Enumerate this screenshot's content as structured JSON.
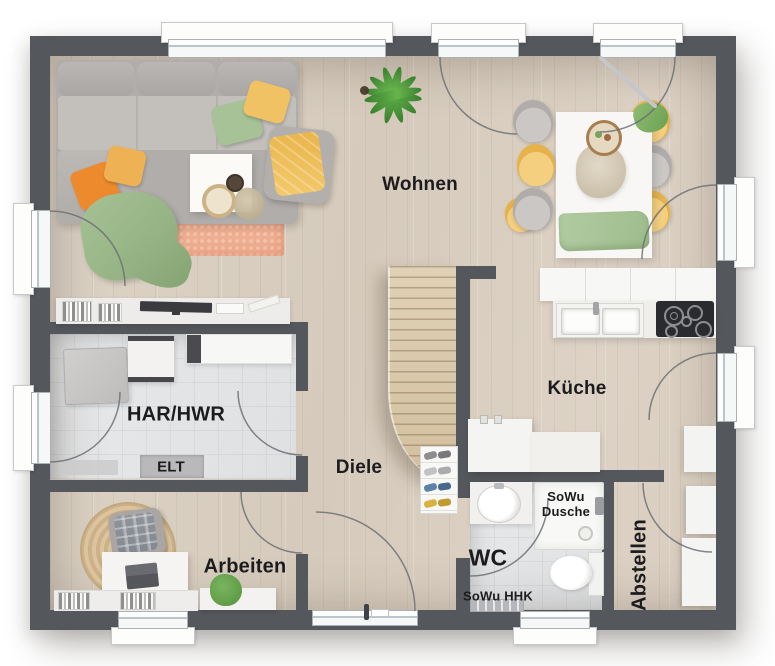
{
  "floorplan": {
    "rooms": {
      "wohnen": "Wohnen",
      "kueche": "Küche",
      "har_hwr": "HAR/HWR",
      "elt": "ELT",
      "diele": "Diele",
      "arbeiten": "Arbeiten",
      "wc": "WC",
      "sowu_dusche": "SoWu Dusche",
      "sowu_hhk": "SoWu HHK",
      "abstellen": "Abstellen"
    },
    "colors": {
      "wall": "#54575c",
      "floor_wood": "#d9cfc2",
      "floor_tile": "#e4e5e7",
      "counter_white": "#f4f4f2",
      "rug_living": "#efae90",
      "accent_orange": "#ee8a2e",
      "accent_yellow": "#f0c263",
      "accent_green": "#a6c296",
      "sofa_gray": "#b7b4b1",
      "stairs_wood": "#d9c7a9",
      "cooktop_black": "#2a2b2e",
      "label_color": "#1c1c1e"
    }
  }
}
